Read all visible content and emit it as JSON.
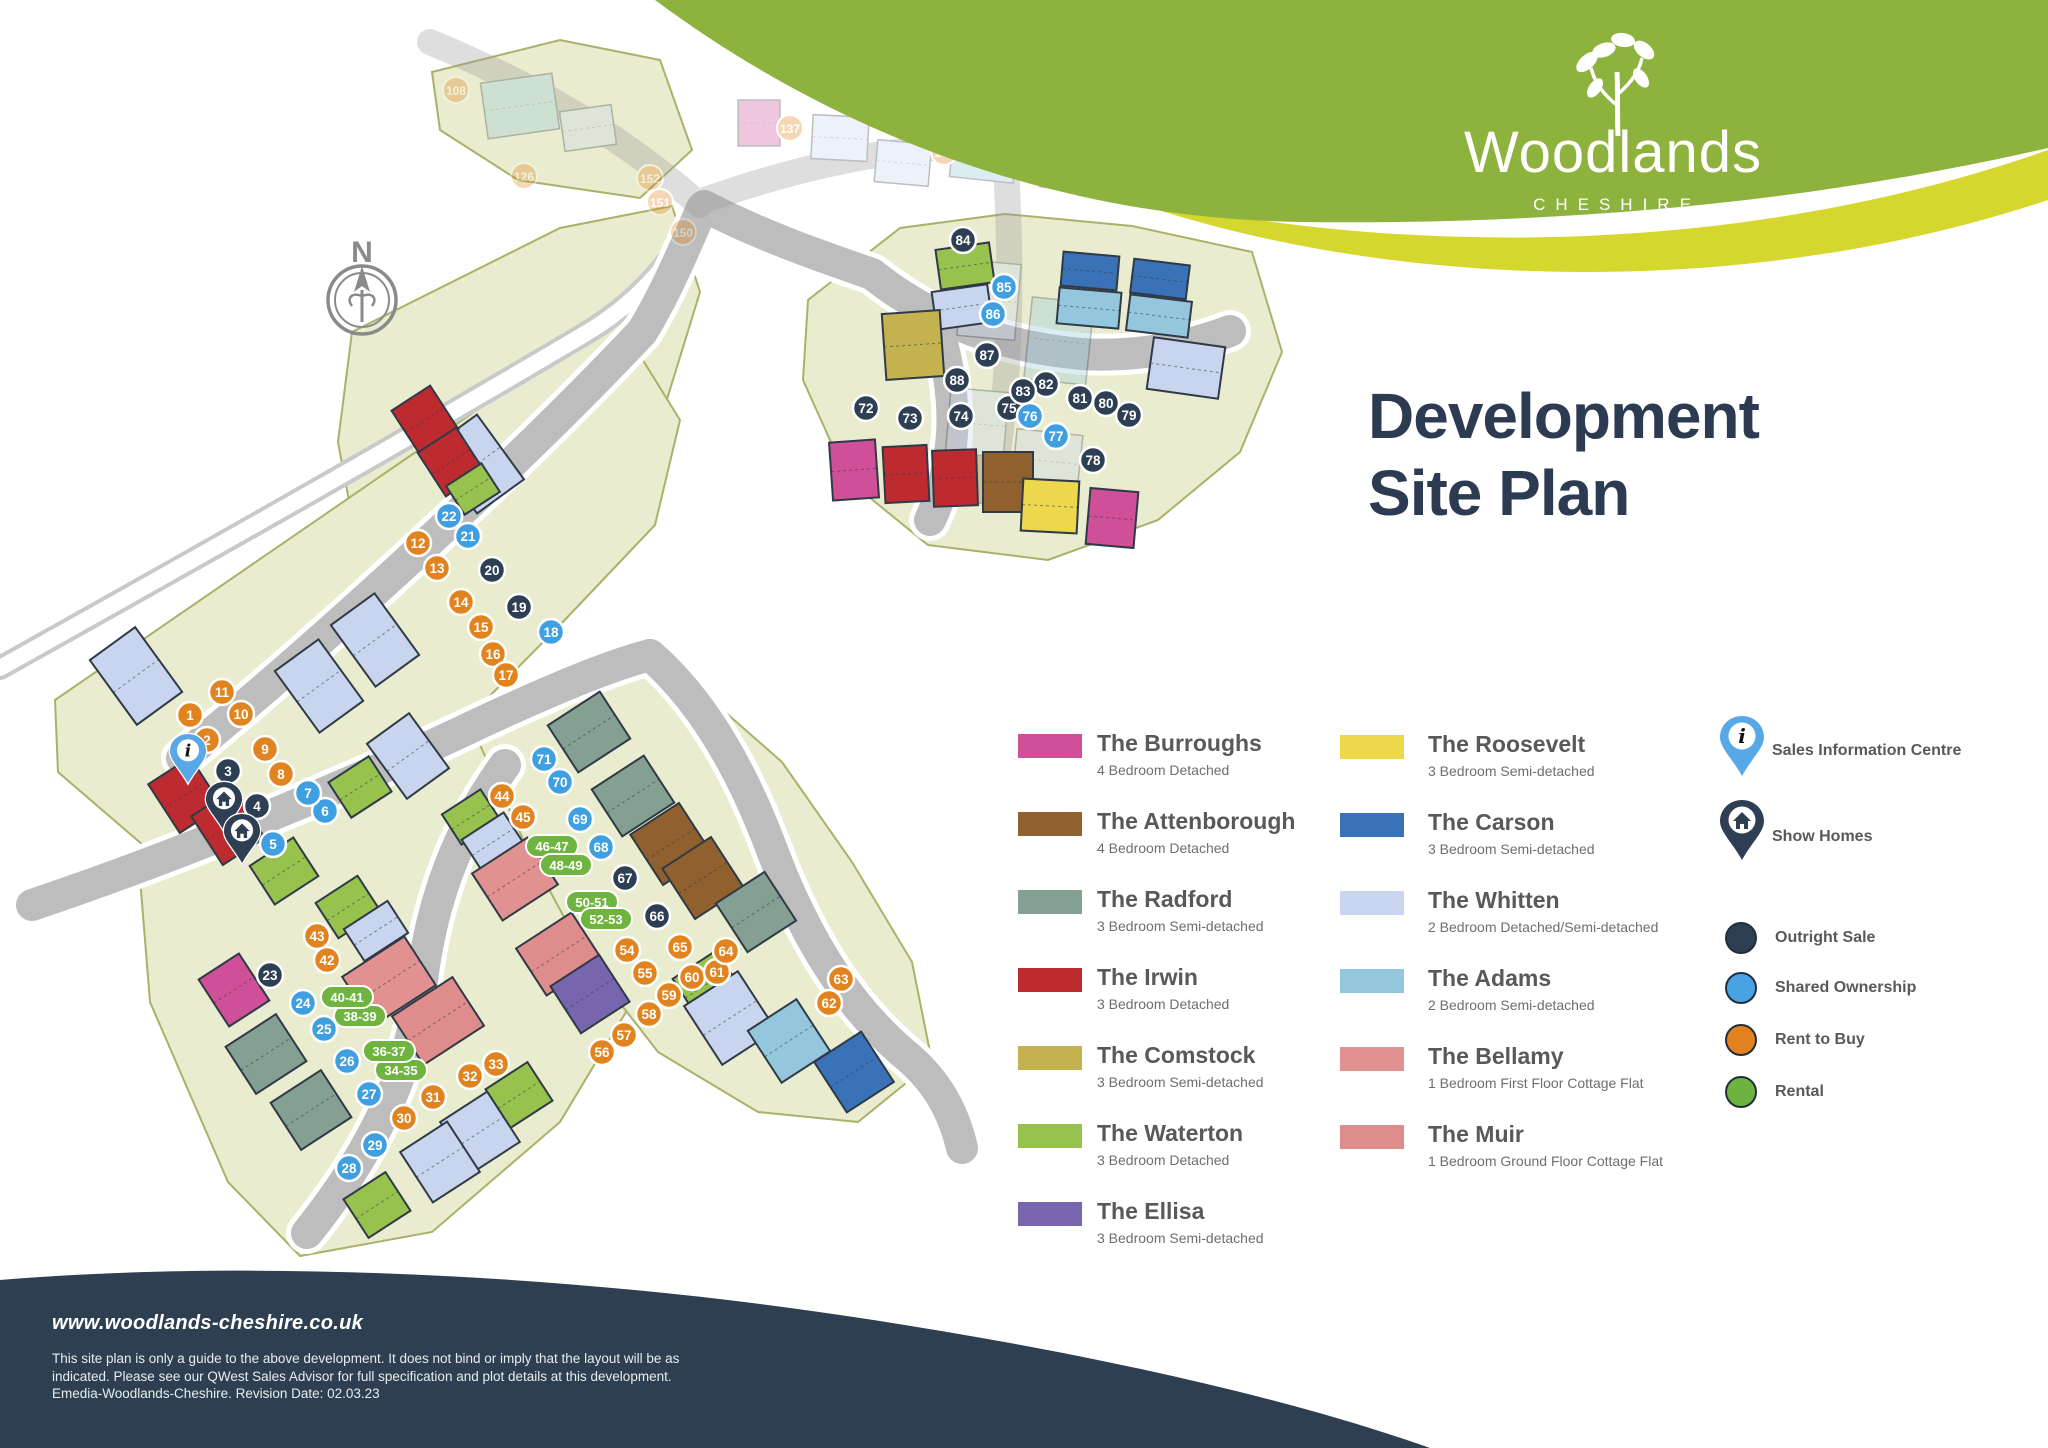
{
  "brand": {
    "name": "Woodlands",
    "region": "CHESHIRE"
  },
  "title": {
    "line1": "Development",
    "line2": "Site Plan"
  },
  "compass": {
    "label": "N"
  },
  "legend": {
    "columns": [
      {
        "items": [
          {
            "name": "The Burroughs",
            "spec": "4 Bedroom Detached",
            "color": "#cf5098"
          },
          {
            "name": "The Attenborough",
            "spec": "4 Bedroom Detached",
            "color": "#91602f"
          },
          {
            "name": "The Radford",
            "spec": "3 Bedroom Semi-detached",
            "color": "#84a092"
          },
          {
            "name": "The Irwin",
            "spec": "3 Bedroom Detached",
            "color": "#bd2b30"
          },
          {
            "name": "The Comstock",
            "spec": "3 Bedroom Semi-detached",
            "color": "#c4b24f"
          },
          {
            "name": "The Waterton",
            "spec": "3 Bedroom Detached",
            "color": "#97c24e"
          },
          {
            "name": "The Ellisa",
            "spec": "3 Bedroom Semi-detached",
            "color": "#7766ad"
          }
        ]
      },
      {
        "items": [
          {
            "name": "The Roosevelt",
            "spec": "3 Bedroom Semi-detached",
            "color": "#edd84c"
          },
          {
            "name": "The Carson",
            "spec": "3 Bedroom Semi-detached",
            "color": "#3a72b8"
          },
          {
            "name": "The Whitten",
            "spec": "2 Bedroom Detached/Semi-detached",
            "color": "#c9d5ee"
          },
          {
            "name": "The Adams",
            "spec": "2 Bedroom Semi-detached",
            "color": "#94c7dd"
          },
          {
            "name": "The Bellamy",
            "spec": "1 Bedroom First Floor Cottage Flat",
            "color": "#e19190"
          },
          {
            "name": "The Muir",
            "spec": "1 Bedroom Ground Floor Cottage Flat",
            "color": "#df8d8c"
          }
        ]
      }
    ],
    "markers": [
      {
        "label": "Sales Information Centre",
        "type": "info-pin",
        "color": "#58a8e8"
      },
      {
        "label": "Show Homes",
        "type": "home-pin",
        "color": "#2e3f54"
      }
    ],
    "tenures": [
      {
        "label": "Outright Sale",
        "color": "#2e3f54"
      },
      {
        "label": "Shared Ownership",
        "color": "#49a2e3"
      },
      {
        "label": "Rent to Buy",
        "color": "#e2821e"
      },
      {
        "label": "Rental",
        "color": "#6cb33f"
      }
    ]
  },
  "footer": {
    "website": "www.woodlands-cheshire.co.uk",
    "disclaimer_lines": [
      "This site plan is only a guide to the above development. It does not bind or imply that the layout will be as",
      "indicated. Please see our QWest Sales Advisor for full specification and plot details at this development.",
      "Emedia-Woodlands-Cheshire. Revision Date: 02.03.23"
    ]
  },
  "map": {
    "palette": {
      "burroughs": "#cf5098",
      "attenborough": "#91602f",
      "radford": "#84a092",
      "irwin": "#bd2b30",
      "comstock": "#c4b24f",
      "waterton": "#97c24e",
      "ellisa": "#7766ad",
      "roosevelt": "#edd84c",
      "carson": "#3a72b8",
      "whitten": "#c9d5ee",
      "adams": "#94c7dd",
      "bellamy": "#e19190",
      "muir": "#df8d8c",
      "parcel": "#e9ecce",
      "parcel_line": "#aab168",
      "road": "#bdbdbd",
      "navy": "#2e3f54",
      "blue": "#3f9fe0",
      "orange": "#e1841f",
      "pill": "#6eb43f"
    },
    "greens": [
      "352,332 560,228 672,206 700,292 660,422 562,540 432,618 360,560 338,442",
      "432,72 560,40 660,60 692,150 640,198 518,180 440,130"
    ],
    "clusters": [
      "55,700 615,315 680,420 655,525 560,625 468,718 328,792 158,858 58,772",
      "140,878 300,808 480,738 560,782 625,880 632,1002 560,1122 432,1232 300,1256 228,1182 150,1002",
      "480,745 600,663 700,690 782,762 852,862 912,962 932,1062 858,1122 758,1112 658,1052 588,962 528,850",
      "808,300 900,228 1005,214 1132,226 1252,252 1282,352 1240,452 1158,520 1048,560 928,545 848,480 803,380"
    ],
    "boundary_road": "M0,668 C220,545 420,432 588,332 C646,297 682,248 704,202",
    "roads": [
      "M642,332 C545,435 360,612 182,758",
      "M642,332 C662,300 682,255 702,208",
      "M32,905 C210,845 382,770 482,722 C562,685 612,665 650,655",
      "M650,655 C702,700 742,770 772,850 C802,930 842,1000 902,1052 C932,1076 952,1105 962,1148",
      "M505,765 C458,830 432,900 422,980 C412,1060 382,1140 307,1233",
      "M704,206 C762,236 820,256 872,274",
      "M872,274 C932,322 1002,347 1082,354 C1132,357 1182,349 1230,331",
      "M940,336 C958,400 958,460 930,520"
    ],
    "houses": [
      [
        "waterton",
        938,
        246,
        54,
        40,
        -8
      ],
      [
        "whitten",
        934,
        288,
        56,
        38,
        -8
      ],
      [
        "comstock",
        884,
        312,
        58,
        66,
        -4
      ],
      [
        "carson",
        1062,
        254,
        56,
        34,
        5
      ],
      [
        "adams",
        1058,
        290,
        62,
        36,
        5
      ],
      [
        "carson",
        1132,
        262,
        56,
        34,
        7
      ],
      [
        "adams",
        1128,
        298,
        62,
        36,
        7
      ],
      [
        "whitten",
        1150,
        342,
        72,
        52,
        8
      ],
      [
        "burroughs",
        831,
        441,
        46,
        58,
        -4
      ],
      [
        "irwin",
        884,
        446,
        44,
        56,
        -3
      ],
      [
        "irwin",
        933,
        450,
        44,
        56,
        -2
      ],
      [
        "attenborough",
        983,
        452,
        50,
        60,
        0
      ],
      [
        "roosevelt",
        1022,
        480,
        56,
        52,
        3
      ],
      [
        "burroughs",
        1088,
        490,
        48,
        56,
        5
      ],
      [
        "whitten",
        108,
        636,
        56,
        80,
        -36
      ],
      [
        "whitten",
        448,
        424,
        58,
        80,
        -36
      ],
      [
        "irwin",
        402,
        394,
        46,
        52,
        -33
      ],
      [
        "irwin",
        428,
        436,
        46,
        52,
        -33
      ],
      [
        "waterton",
        452,
        472,
        42,
        34,
        -33
      ],
      [
        "whitten",
        292,
        648,
        54,
        76,
        -36
      ],
      [
        "whitten",
        348,
        602,
        54,
        76,
        -36
      ],
      [
        "waterton",
        336,
        766,
        48,
        42,
        -33
      ],
      [
        "whitten",
        382,
        722,
        52,
        68,
        -36
      ],
      [
        "irwin",
        160,
        766,
        50,
        58,
        -33
      ],
      [
        "irwin",
        203,
        798,
        50,
        58,
        -33
      ],
      [
        "waterton",
        258,
        848,
        52,
        46,
        -33
      ],
      [
        "burroughs",
        210,
        962,
        48,
        56,
        -33
      ],
      [
        "radford",
        236,
        1026,
        60,
        56,
        -33
      ],
      [
        "radford",
        281,
        1082,
        60,
        56,
        -33
      ],
      [
        "bellamy",
        352,
        952,
        74,
        58,
        -33
      ],
      [
        "muir",
        402,
        992,
        72,
        58,
        -33
      ],
      [
        "waterton",
        494,
        1072,
        50,
        46,
        -33
      ],
      [
        "whitten",
        452,
        1102,
        56,
        60,
        -33
      ],
      [
        "whitten",
        412,
        1132,
        56,
        60,
        -33
      ],
      [
        "waterton",
        352,
        1182,
        50,
        46,
        -33
      ],
      [
        "waterton",
        323,
        886,
        50,
        42,
        -33
      ],
      [
        "whitten",
        350,
        912,
        52,
        38,
        -33
      ],
      [
        "waterton",
        448,
        799,
        46,
        36,
        -33
      ],
      [
        "whitten",
        468,
        823,
        50,
        38,
        -33
      ],
      [
        "bellamy",
        482,
        851,
        66,
        56,
        -33
      ],
      [
        "muir",
        526,
        926,
        66,
        56,
        -33
      ],
      [
        "ellisa",
        561,
        966,
        58,
        56,
        -33
      ],
      [
        "radford",
        558,
        704,
        62,
        56,
        -33
      ],
      [
        "radford",
        602,
        768,
        62,
        56,
        -33
      ],
      [
        "attenborough",
        642,
        814,
        58,
        60,
        -33
      ],
      [
        "attenborough",
        674,
        848,
        58,
        60,
        -33
      ],
      [
        "radford",
        727,
        883,
        58,
        58,
        -33
      ],
      [
        "waterton",
        681,
        961,
        52,
        46,
        -33
      ],
      [
        "whitten",
        698,
        983,
        64,
        70,
        -33
      ],
      [
        "adams",
        760,
        1010,
        58,
        62,
        -33
      ],
      [
        "carson",
        826,
        1042,
        56,
        60,
        -33
      ]
    ],
    "plots": [
      [
        1,
        190,
        715,
        "o"
      ],
      [
        2,
        207,
        740,
        "o"
      ],
      [
        3,
        228,
        771,
        "n"
      ],
      [
        4,
        257,
        806,
        "n"
      ],
      [
        5,
        273,
        844,
        "b"
      ],
      [
        6,
        325,
        811,
        "b"
      ],
      [
        7,
        308,
        793,
        "b"
      ],
      [
        8,
        281,
        774,
        "o"
      ],
      [
        9,
        265,
        749,
        "o"
      ],
      [
        10,
        241,
        714,
        "o"
      ],
      [
        11,
        222,
        692,
        "o"
      ],
      [
        12,
        418,
        543,
        "o"
      ],
      [
        13,
        437,
        568,
        "o"
      ],
      [
        14,
        461,
        602,
        "o"
      ],
      [
        15,
        481,
        627,
        "o"
      ],
      [
        16,
        493,
        654,
        "o"
      ],
      [
        17,
        506,
        675,
        "o"
      ],
      [
        18,
        551,
        632,
        "b"
      ],
      [
        19,
        519,
        607,
        "n"
      ],
      [
        20,
        492,
        570,
        "n"
      ],
      [
        21,
        468,
        536,
        "b"
      ],
      [
        22,
        449,
        516,
        "b"
      ],
      [
        23,
        270,
        975,
        "n"
      ],
      [
        24,
        303,
        1003,
        "b"
      ],
      [
        25,
        324,
        1029,
        "b"
      ],
      [
        26,
        347,
        1061,
        "b"
      ],
      [
        27,
        369,
        1094,
        "b"
      ],
      [
        28,
        349,
        1168,
        "b"
      ],
      [
        29,
        375,
        1145,
        "b"
      ],
      [
        30,
        404,
        1118,
        "o"
      ],
      [
        31,
        433,
        1097,
        "o"
      ],
      [
        32,
        470,
        1076,
        "o"
      ],
      [
        33,
        496,
        1064,
        "o"
      ],
      [
        42,
        327,
        960,
        "o"
      ],
      [
        43,
        317,
        936,
        "o"
      ],
      [
        44,
        502,
        796,
        "o"
      ],
      [
        45,
        523,
        817,
        "o"
      ],
      [
        54,
        627,
        950,
        "o"
      ],
      [
        55,
        645,
        973,
        "o"
      ],
      [
        56,
        602,
        1052,
        "o"
      ],
      [
        57,
        624,
        1035,
        "o"
      ],
      [
        58,
        649,
        1014,
        "o"
      ],
      [
        59,
        669,
        995,
        "o"
      ],
      [
        60,
        692,
        977,
        "o"
      ],
      [
        61,
        717,
        972,
        "o"
      ],
      [
        62,
        829,
        1003,
        "o"
      ],
      [
        63,
        841,
        979,
        "o"
      ],
      [
        64,
        726,
        951,
        "o"
      ],
      [
        65,
        680,
        947,
        "o"
      ],
      [
        66,
        657,
        916,
        "n"
      ],
      [
        67,
        625,
        878,
        "n"
      ],
      [
        68,
        601,
        847,
        "b"
      ],
      [
        69,
        580,
        819,
        "b"
      ],
      [
        70,
        560,
        782,
        "b"
      ],
      [
        71,
        544,
        759,
        "b"
      ],
      [
        72,
        866,
        408,
        "n"
      ],
      [
        73,
        910,
        418,
        "n"
      ],
      [
        74,
        961,
        416,
        "n"
      ],
      [
        75,
        1009,
        408,
        "n"
      ],
      [
        76,
        1030,
        416,
        "b"
      ],
      [
        77,
        1056,
        436,
        "b"
      ],
      [
        78,
        1093,
        460,
        "n"
      ],
      [
        79,
        1129,
        415,
        "n"
      ],
      [
        80,
        1106,
        403,
        "n"
      ],
      [
        81,
        1080,
        398,
        "n"
      ],
      [
        82,
        1046,
        384,
        "n"
      ],
      [
        83,
        1023,
        391,
        "n"
      ],
      [
        84,
        963,
        240,
        "n"
      ],
      [
        85,
        1004,
        287,
        "b"
      ],
      [
        86,
        993,
        314,
        "b"
      ],
      [
        87,
        987,
        355,
        "n"
      ],
      [
        88,
        957,
        380,
        "n"
      ]
    ],
    "flat_plots": [
      [
        "34-35",
        401,
        1070
      ],
      [
        "36-37",
        389,
        1051
      ],
      [
        "38-39",
        360,
        1016
      ],
      [
        "40-41",
        347,
        997
      ],
      [
        "46-47",
        552,
        846
      ],
      [
        "48-49",
        566,
        865
      ],
      [
        "50-51",
        592,
        902
      ],
      [
        "52-53",
        606,
        919
      ]
    ],
    "ghost": {
      "roads": [
        "M430,42 C540,88 620,135 700,205",
        "M705,200 C790,170 880,148 980,145 C1060,143 1140,152 1210,170",
        "M1005,150 C1012,260 1012,370 995,470"
      ],
      "houses": [
        [
          "adams",
          484,
          78,
          72,
          56,
          -8
        ],
        [
          "whitten",
          562,
          108,
          52,
          40,
          -8
        ],
        [
          "burroughs",
          738,
          100,
          42,
          46,
          0
        ],
        [
          "whitten",
          812,
          116,
          56,
          44,
          3
        ],
        [
          "whitten",
          876,
          142,
          54,
          42,
          5
        ],
        [
          "adams",
          952,
          128,
          64,
          52,
          6
        ],
        [
          "whitten",
          1042,
          140,
          60,
          50,
          6
        ],
        [
          "whitten",
          960,
          262,
          58,
          76,
          5
        ],
        [
          "adams",
          1028,
          300,
          62,
          82,
          6
        ],
        [
          "whitten",
          948,
          390,
          58,
          68,
          5
        ],
        [
          "whitten",
          1014,
          432,
          66,
          58,
          6
        ],
        [
          "attenborough",
          948,
          455,
          52,
          48,
          4
        ]
      ],
      "plots": [
        [
          108,
          456,
          90
        ],
        [
          126,
          524,
          176
        ],
        [
          137,
          790,
          128
        ],
        [
          143,
          944,
          152
        ],
        [
          150,
          683,
          232
        ],
        [
          151,
          660,
          202
        ],
        [
          152,
          650,
          178
        ]
      ]
    },
    "site_markers": [
      {
        "type": "info-pin",
        "x": 188,
        "y": 752
      },
      {
        "type": "home-pin",
        "x": 224,
        "y": 800
      },
      {
        "type": "home-pin",
        "x": 242,
        "y": 832
      }
    ]
  }
}
